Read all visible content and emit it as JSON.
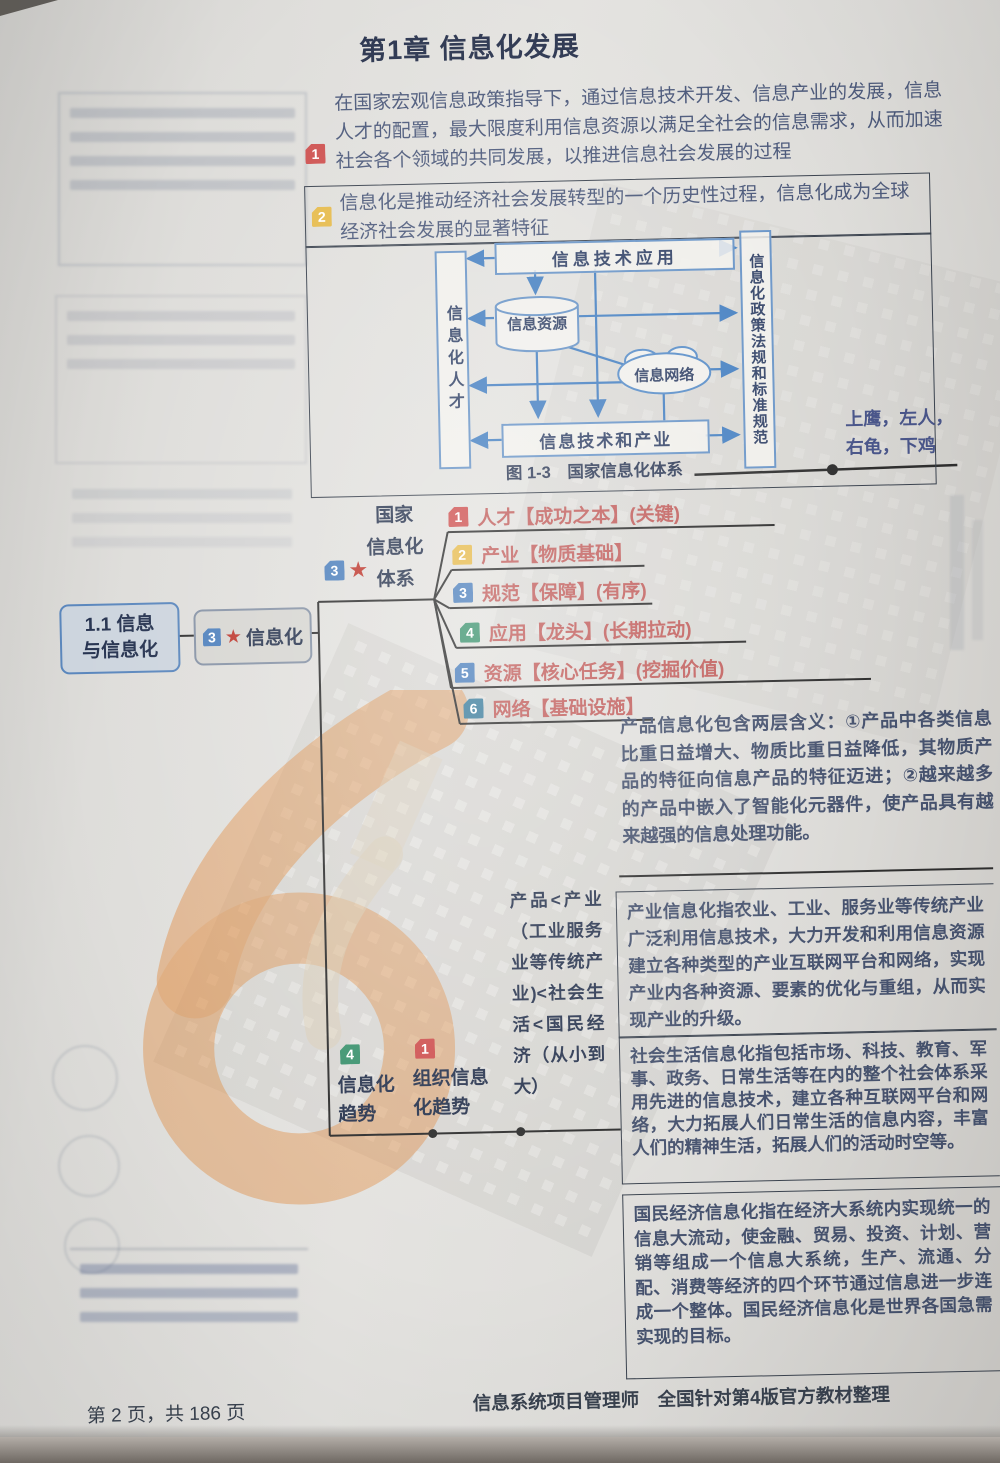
{
  "page": {
    "title": "第1章 信息化发展",
    "footer_left": "第 2 页，共 186 页",
    "footer_right": "信息系统项目管理师　全国针对第4版官方教材整理"
  },
  "colors": {
    "red": "#cf5352",
    "yellow": "#e6bb4d",
    "blue": "#4f81bd",
    "green": "#3e9470",
    "teal": "#3f7f9e",
    "branch_text": "#c2605e",
    "diagram_line": "#4a83c3",
    "watermark_orange": "#e0812f"
  },
  "intro": {
    "badge": "1",
    "badge_color": "#cf5352",
    "text": "在国家宏观信息政策指导下，通过信息技术开发、信息产业的发展，信息人才的配置，最大限度利用信息资源以满足全社会的信息需求，从而加速社会各个领域的共同发展，以推进信息社会发展的过程"
  },
  "definition": {
    "badge": "2",
    "badge_color": "#e6bb4d",
    "text": "信息化是推动经济社会发展转型的一个历史性过程，信息化成为全球经济社会发展的显著特征"
  },
  "diagram": {
    "caption": "图 1-3　国家信息化体系",
    "left_box": "信息化人才",
    "top_box": "信息技术应用",
    "cylinder": "信息资源",
    "cloud": "信息网络",
    "bottom_box": "信息技术和产业",
    "right_box": "信息化政策法规和标准规范",
    "note": "上鹰，左人，右龟，下鸡"
  },
  "mindmap": {
    "root": "1.1 信息与信息化",
    "node": {
      "badge": "3",
      "badge_color": "#4f81bd",
      "star": "★",
      "label": "信息化"
    },
    "system": {
      "badge": "3",
      "badge_color": "#4f81bd",
      "star": "★",
      "line1": "国家",
      "line2": "信息化",
      "line3": "体系"
    },
    "branches": [
      {
        "num": "1",
        "color": "#cf5352",
        "text": "人才【成功之本】(关键)"
      },
      {
        "num": "2",
        "color": "#e6bb4d",
        "text": "产业【物质基础】"
      },
      {
        "num": "3",
        "color": "#4f81bd",
        "text": "规范【保障】(有序)"
      },
      {
        "num": "4",
        "color": "#3e9470",
        "text": "应用【龙头】(长期拉动)"
      },
      {
        "num": "5",
        "color": "#4f81bd",
        "text": "资源【核心任务】(挖掘价值)"
      },
      {
        "num": "6",
        "color": "#3f7f9e",
        "text": "网络【基础设施】"
      }
    ],
    "trend": {
      "badge": "4",
      "badge_color": "#3e9470",
      "label": "信息化趋势"
    },
    "org_trend": {
      "badge": "1",
      "badge_color": "#cf5352",
      "label": "组织信息化趋势"
    },
    "order_note": "产品<产业（工业服务业等传统产业)<社会生活<国民经济（从小到大）"
  },
  "details": [
    {
      "text": "产品信息化包含两层含义：①产品中各类信息比重日益增大、物质比重日益降低，其物质产品的特征向信息产品的特征迈进；②越来越多的产品中嵌入了智能化元器件，使产品具有越来越强的信息处理功能。"
    },
    {
      "text": "产业信息化指农业、工业、服务业等传统产业广泛利用信息技术，大力开发和利用信息资源建立各种类型的产业互联网平台和网络，实现产业内各种资源、要素的优化与重组，从而实现产业的升级。"
    },
    {
      "text": "社会生活信息化指包括市场、科技、教育、军事、政务、日常生活等在内的整个社会体系采用先进的信息技术，建立各种互联网平台和网络，大力拓展人们日常生活的信息内容，丰富人们的精神生活，拓展人们的活动时空等。"
    },
    {
      "text": "国民经济信息化指在经济大系统内实现统一的信息大流动，使金融、贸易、投资、计划、营销等组成一个信息大系统，生产、流通、分配、消费等经济的四个环节通过信息进一步连成一个整体。国民经济信息化是世界各国急需实现的目标。"
    }
  ]
}
